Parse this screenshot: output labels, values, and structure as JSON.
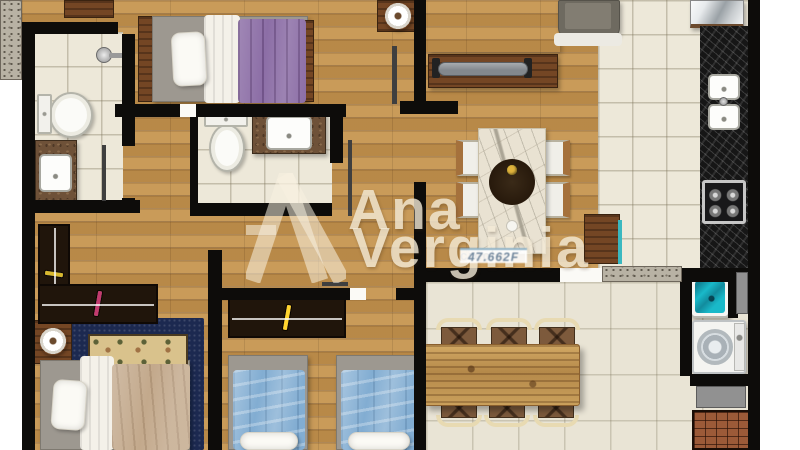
{
  "watermark": {
    "brand_line1": "Ana",
    "brand_line2": "Verginia",
    "credential_label": "creci",
    "credential_number": "47.662F",
    "monogram": "AV"
  },
  "palette": {
    "wall": "#0d0c0a",
    "wood_floor": "#c6954f",
    "tile_floor": "#ede8d9",
    "balcony_tile": "#e9e4d5",
    "black_granite": "#161616",
    "brown_marble": "#6e5138",
    "white_marble": "#e9e2d2",
    "purple_blanket": "#8c6ea6",
    "blue_blanket": "#82add2",
    "tan_blanket": "#c3a98c",
    "navy_rug": "#1c2950",
    "gold_tapestry": "#d9c28c",
    "turquoise_water": "#19b9c9",
    "sofa_gray": "#7f7b70",
    "rustic_table": "#c09355",
    "chair_brown": "#7d5a3c",
    "chair_back_cream": "#e8dab2",
    "brick": "#9c5a38",
    "watermark_cream": "#f3ead6"
  },
  "living_rug_cells": [
    "#1d3b52",
    "#bfcdd2",
    "#e3e6e4",
    "#23455c",
    "#9fb2ba",
    "#2f5870",
    "#11151d",
    "#9b9fa3",
    "#667c88",
    "#2c4a62",
    "#c6d0d3",
    "#1b2d44"
  ],
  "closet_tall_colors": [
    "#d8d8d8",
    "#c23a2e",
    "#3a7dd8",
    "#28c8b8",
    "#e8e8e8",
    "#2a2ad8",
    "#d8b82e"
  ],
  "closet_wide_colors": [
    "#c23a2e",
    "#e8e8e8",
    "#ffd42e",
    "#2a5ad8",
    "#9c3ad8",
    "#28c8b8",
    "#6ad83a",
    "#e87a2e",
    "#d8d8d8",
    "#c23a6e"
  ],
  "closet_bedroom3_colors": [
    "#c23a2e",
    "#e8e8e8",
    "#ffd42e",
    "#3a5ad8",
    "#8a2ad8",
    "#28c8b8",
    "#6ad83a",
    "#e8e8e8",
    "#2a9ad8",
    "#d84a9a",
    "#ffd42e"
  ],
  "fruit_colors": [
    "#cf2f23",
    "#ff9d22",
    "#ffd42e",
    "#49842c",
    "#2f5d1f",
    "#e0b33c"
  ],
  "rooms": {
    "bathroom_top_left": [
      "shower",
      "toilet",
      "vanity-sink"
    ],
    "bedroom_top": [
      "single-bed",
      "nightstand",
      "lamp"
    ],
    "bathroom_middle": [
      "toilet",
      "vanity-sink"
    ],
    "living_room": [
      "checkered-rug",
      "sofa",
      "tv-rack",
      "tv"
    ],
    "dining_area": [
      "marble-table",
      "fruit-bowl",
      "four-chairs"
    ],
    "kitchen": [
      "fridge",
      "granite-counter",
      "double-sink",
      "cooktop"
    ],
    "bedroom_left": [
      "wardrobe",
      "nightstand",
      "lamp",
      "double-bed",
      "navy-rug",
      "tapestry"
    ],
    "bedroom_bottom": [
      "wardrobe",
      "twin-bed",
      "twin-bed"
    ],
    "balcony": [
      "rustic-wood-table",
      "six-chairs"
    ],
    "laundry": [
      "wash-tank",
      "washing-machine",
      "barbecue-grill"
    ]
  }
}
